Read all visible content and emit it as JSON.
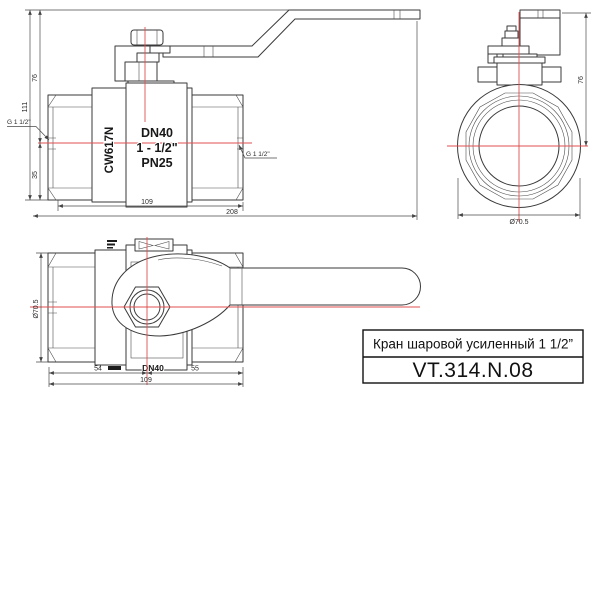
{
  "drawing": {
    "title_block": {
      "title": "Кран шаровой усиленный 1 1/2”",
      "model": "VT.314.N.08"
    },
    "front_view": {
      "marking_material": "CW617N",
      "marking_dn": "DN40",
      "marking_size": "1 - 1/2\"",
      "marking_pn": "PN25",
      "dim_height_to_handle": "76",
      "dim_height_total": "111",
      "dim_height_below_axis": "35",
      "dim_thread_left": "G 1 1/2\"",
      "dim_thread_right": "G 1 1/2\"",
      "dim_body_length": "109",
      "dim_total_length": "208"
    },
    "side_view": {
      "dim_height_to_handle": "76",
      "dim_outer_diameter": "Ø70.5"
    },
    "top_view": {
      "marking_dn": "DN40",
      "dim_outer_diameter": "Ø70.5",
      "dim_left_to_axis": "54",
      "dim_axis_to_right": "55",
      "dim_body_length": "109"
    },
    "colors": {
      "centerline": "#e04f4f",
      "outline": "#3a3a3a",
      "dimension": "#4a4a4a",
      "background": "#ffffff"
    }
  }
}
